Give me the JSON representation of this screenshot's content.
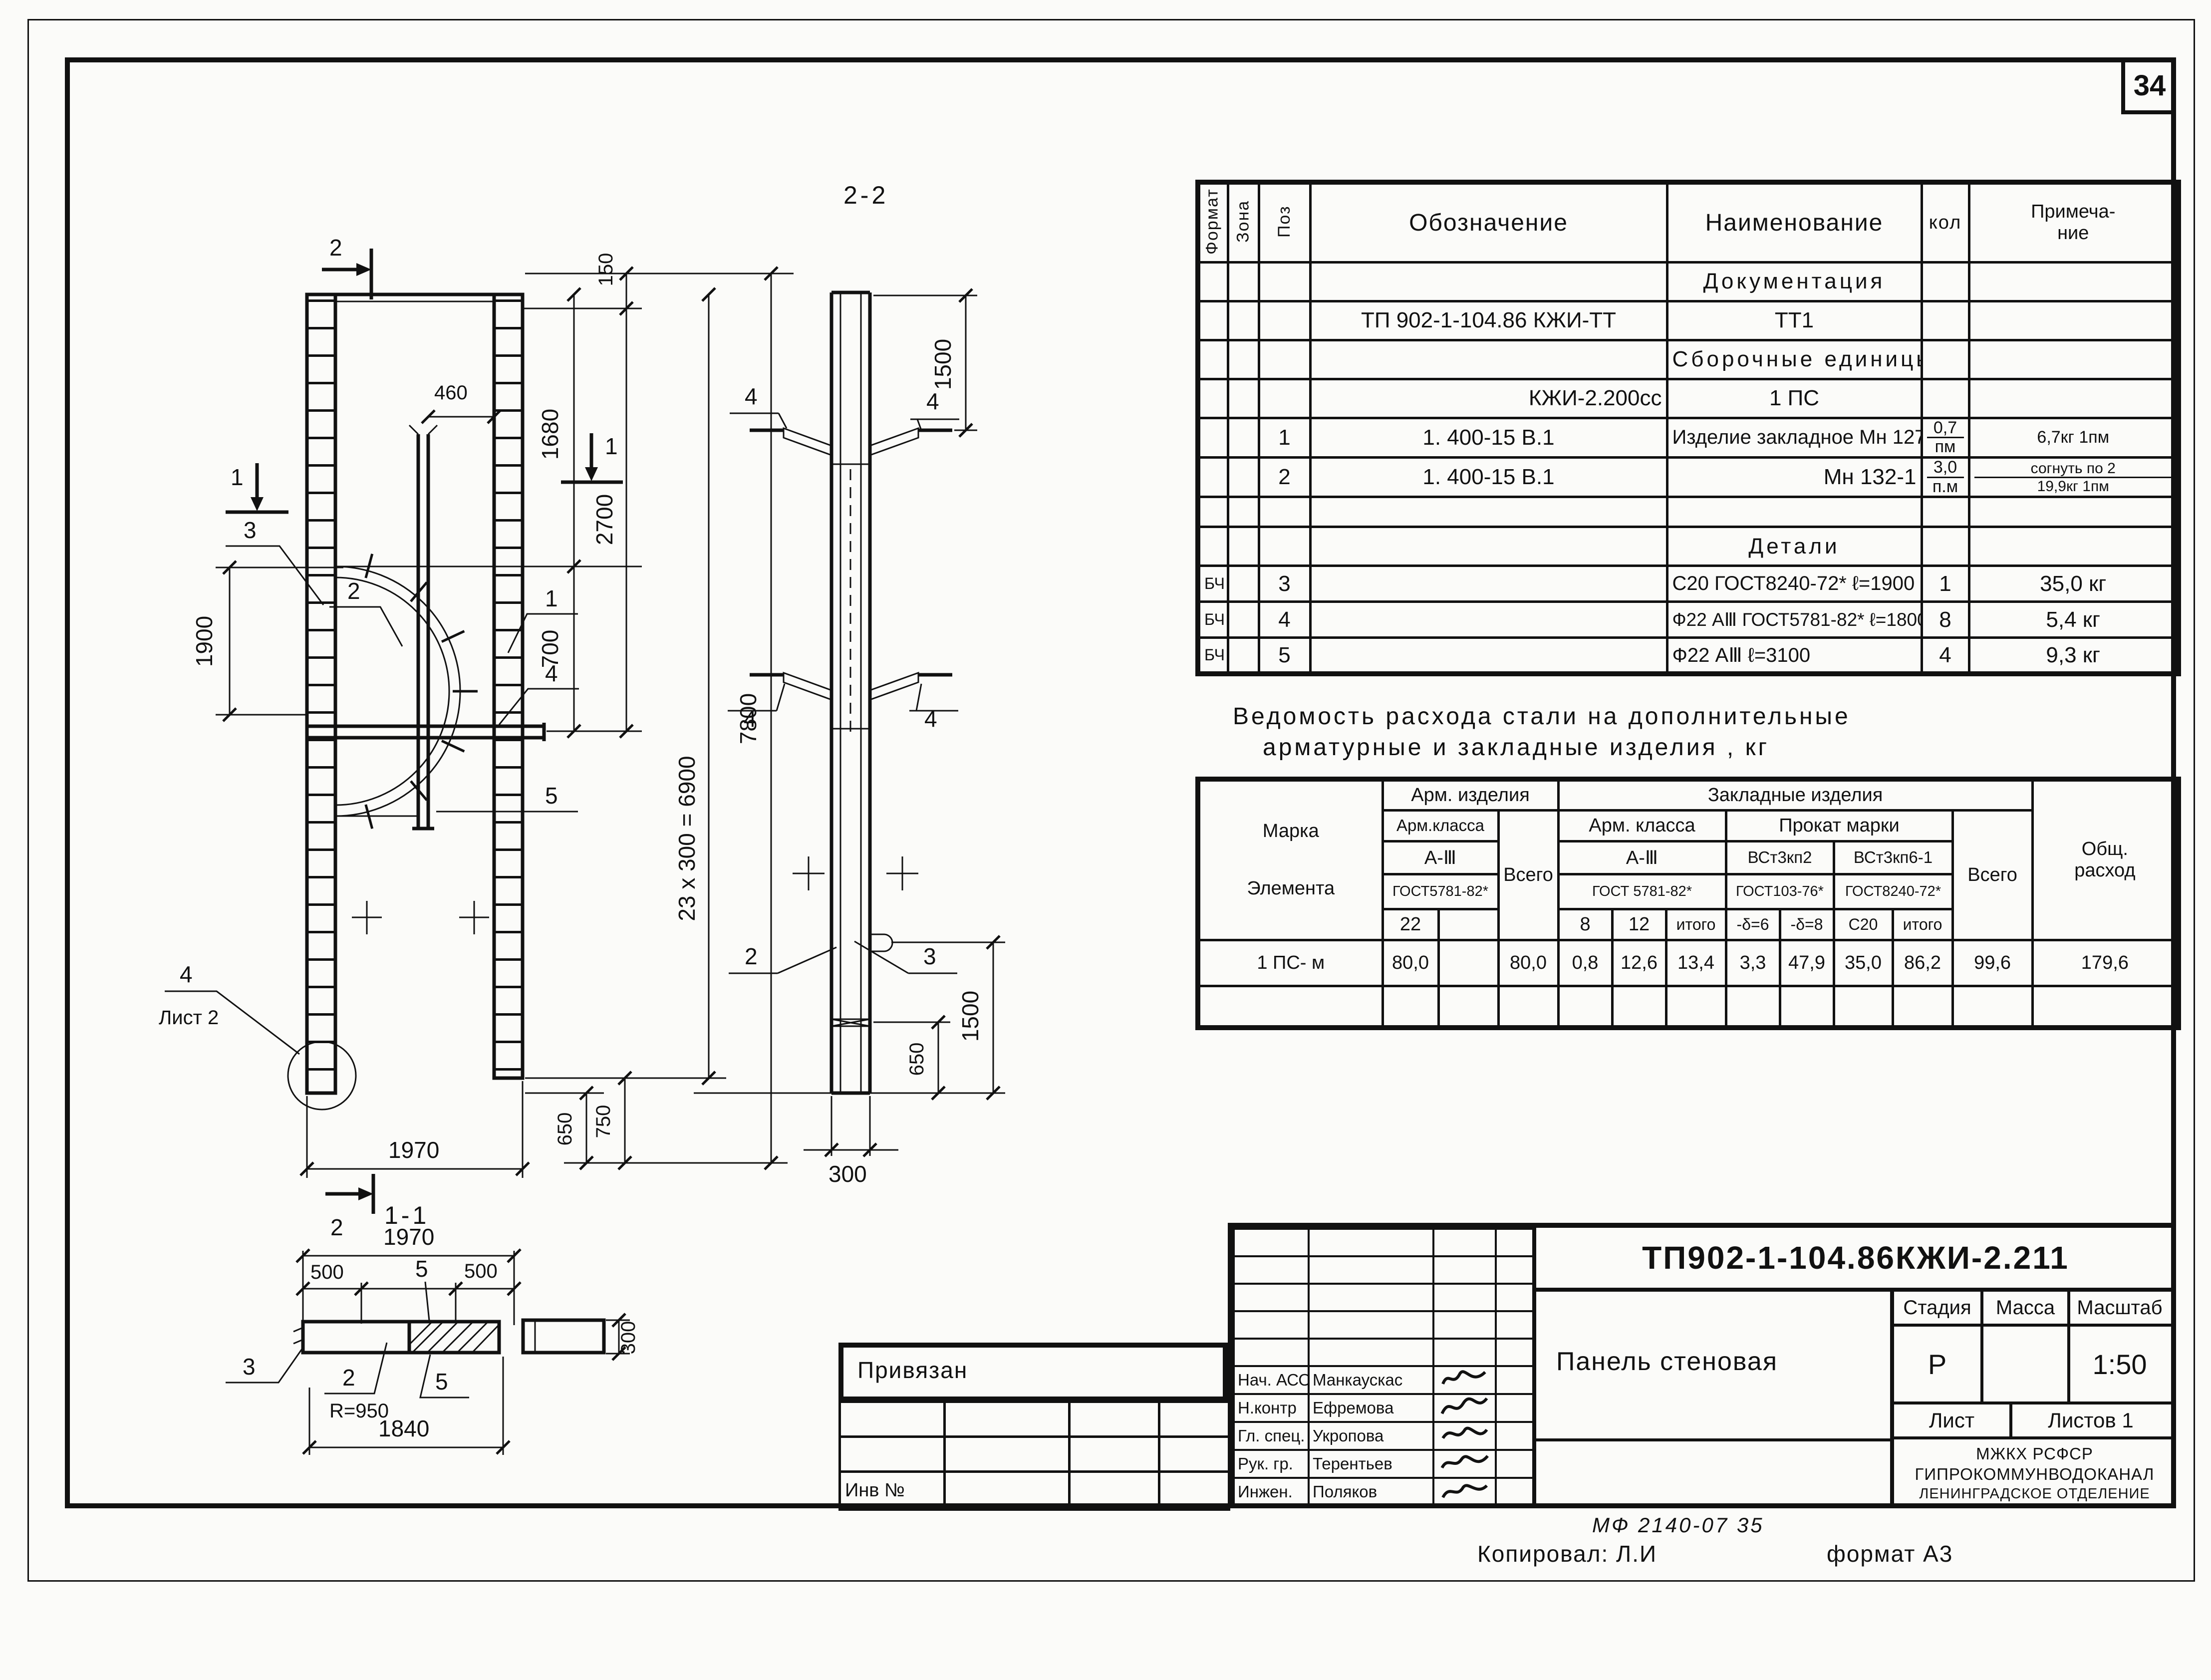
{
  "page": {
    "sheet_number": "34"
  },
  "spec_table": {
    "headers": {
      "format": "Формат",
      "zona": "Зона",
      "poz": "Поз",
      "oboz": "Обозначение",
      "naim": "Наименование",
      "kol": "кол",
      "prim_a": "Примеча-",
      "prim_b": "ние"
    },
    "rows": [
      {
        "section": "Документация"
      },
      {
        "oboz": "ТП 902-1-104.86   КЖИ-ТТ",
        "naim": "ТТ1"
      },
      {
        "section": "Сборочные   единицы"
      },
      {
        "oboz": "КЖИ-2.200сс",
        "naim": "1 ПС"
      },
      {
        "poz": "1",
        "oboz": "1. 400-15 В.1",
        "naim": "Изделие закладное Мн 127-5",
        "kol_a": "0,7",
        "kol_b": "пм",
        "prim": "6,7кг 1пм"
      },
      {
        "poz": "2",
        "oboz": "1. 400-15 В.1",
        "naim": "Мн 132-1",
        "kol_a": "3,0",
        "kol_b": "п.м",
        "prim_a": "согнуть по 2",
        "prim_b": "19,9кг 1пм"
      },
      {},
      {
        "section": "Детали"
      },
      {
        "format": "БЧ",
        "poz": "3",
        "naim": "С20 ГОСТ8240-72*  ℓ=1900",
        "kol": "1",
        "prim": "35,0 кг"
      },
      {
        "format": "БЧ",
        "poz": "4",
        "naim": "Ф22 АⅢ ГОСТ5781-82* ℓ=1800",
        "kol": "8",
        "prim": "5,4 кг"
      },
      {
        "format": "БЧ",
        "poz": "5",
        "naim": "Ф22 АⅢ        ℓ=3100",
        "kol": "4",
        "prim": "9,3 кг"
      }
    ]
  },
  "steel_table": {
    "title1": "Ведомость  расхода  стали   на  дополнительные",
    "title2": "арматурные  и  закладные    изделия , кг",
    "marka_a": "Марка",
    "marka_b": "Элемента",
    "g_arm": "Арм. изделия",
    "g_zakl": "Закладные   изделия",
    "arm_klassa1": "Арм.класса",
    "vsego1": "Всего",
    "arm_klassa2": "Арм. класса",
    "prokat": "Прокат  марки",
    "a3_1": "А-Ⅲ",
    "a3_2": "А-Ⅲ",
    "vst3kp2": "ВСт3кп2",
    "vst3kp61": "ВСт3кп6-1",
    "gost1": "ГОСТ5781-82*",
    "gost2": "ГОСТ 5781-82*",
    "gost3": "ГОСТ103-76*",
    "gost4": "ГОСТ8240-72*",
    "d22": "22",
    "d8": "8",
    "d12": "12",
    "itogo1": "итого",
    "b6": "-δ=6",
    "b8": "-δ=8",
    "c20": "С20",
    "itogo2": "итого",
    "vsego2": "Всего",
    "obsh_a": "Общ.",
    "obsh_b": "расход",
    "row": {
      "marka": "1 ПС- м",
      "v22": "80,0",
      "vblank": "",
      "vsego1": "80,0",
      "v8": "0,8",
      "v12": "12,6",
      "vitogo1": "13,4",
      "vb6": "3,3",
      "vb8": "47,9",
      "vc20": "35,0",
      "vitogo2": "86,2",
      "vsego2": "99,6",
      "obsh": "179,6"
    }
  },
  "title_block": {
    "doc_number": "ТП902-1-104.86КЖИ-2.211",
    "title": "Панель стеновая",
    "stage_label": "Стадия",
    "mass_label": "Масса",
    "scale_label": "Масштаб",
    "stage": "Р",
    "mass": "",
    "scale": "1:50",
    "sheet_label": "Лист",
    "sheets_label": "Листов  1",
    "org1": "МЖКХ       РСФСР",
    "org2": "ГИПРОКОММУНВОДОКАНАЛ",
    "org3": "ЛЕНИНГРАДСКОЕ ОТДЕЛЕНИЕ",
    "signers": [
      {
        "role": "Нач. АСО",
        "name": "Манкаускас"
      },
      {
        "role": "Н.контр",
        "name": "Ефремова"
      },
      {
        "role": "Гл. спец.",
        "name": "Укропова"
      },
      {
        "role": "Рук. гр.",
        "name": "Терентьев"
      },
      {
        "role": "Инжен.",
        "name": "Поляков"
      }
    ],
    "privyazan": "Привязан",
    "inv": "Инв №",
    "footer_code": "МФ 2140-07    35",
    "copied": "Копировал:  Л.И",
    "format": "формат А3"
  },
  "views": {
    "left": {
      "dims": {
        "d150": "150",
        "d460": "460",
        "d1680": "1680",
        "d700": "700",
        "d2700": "2700",
        "d1900": "1900",
        "d6900": "23 x 300 = 6900",
        "d7800": "7800",
        "d650": "650",
        "d750": "750",
        "d1970": "1970"
      },
      "marks": {
        "s1": "1",
        "s2": "2"
      },
      "callouts": {
        "c1": "1",
        "c2": "2",
        "c3": "3",
        "c4": "4",
        "c5": "5",
        "sheet": "Лист 2"
      }
    },
    "mid": {
      "title": "2-2",
      "dims": {
        "d1500": "1500",
        "d650": "650",
        "d300": "300"
      },
      "callouts": {
        "c2": "2",
        "c3": "3",
        "c4": "4"
      }
    },
    "bottom": {
      "title": "1-1",
      "dims": {
        "d1970": "1970",
        "d500": "500",
        "r950": "R=950",
        "d1840": "1840",
        "d300": "300"
      },
      "callouts": {
        "c2": "2",
        "c3": "3",
        "c5": "5"
      }
    }
  }
}
